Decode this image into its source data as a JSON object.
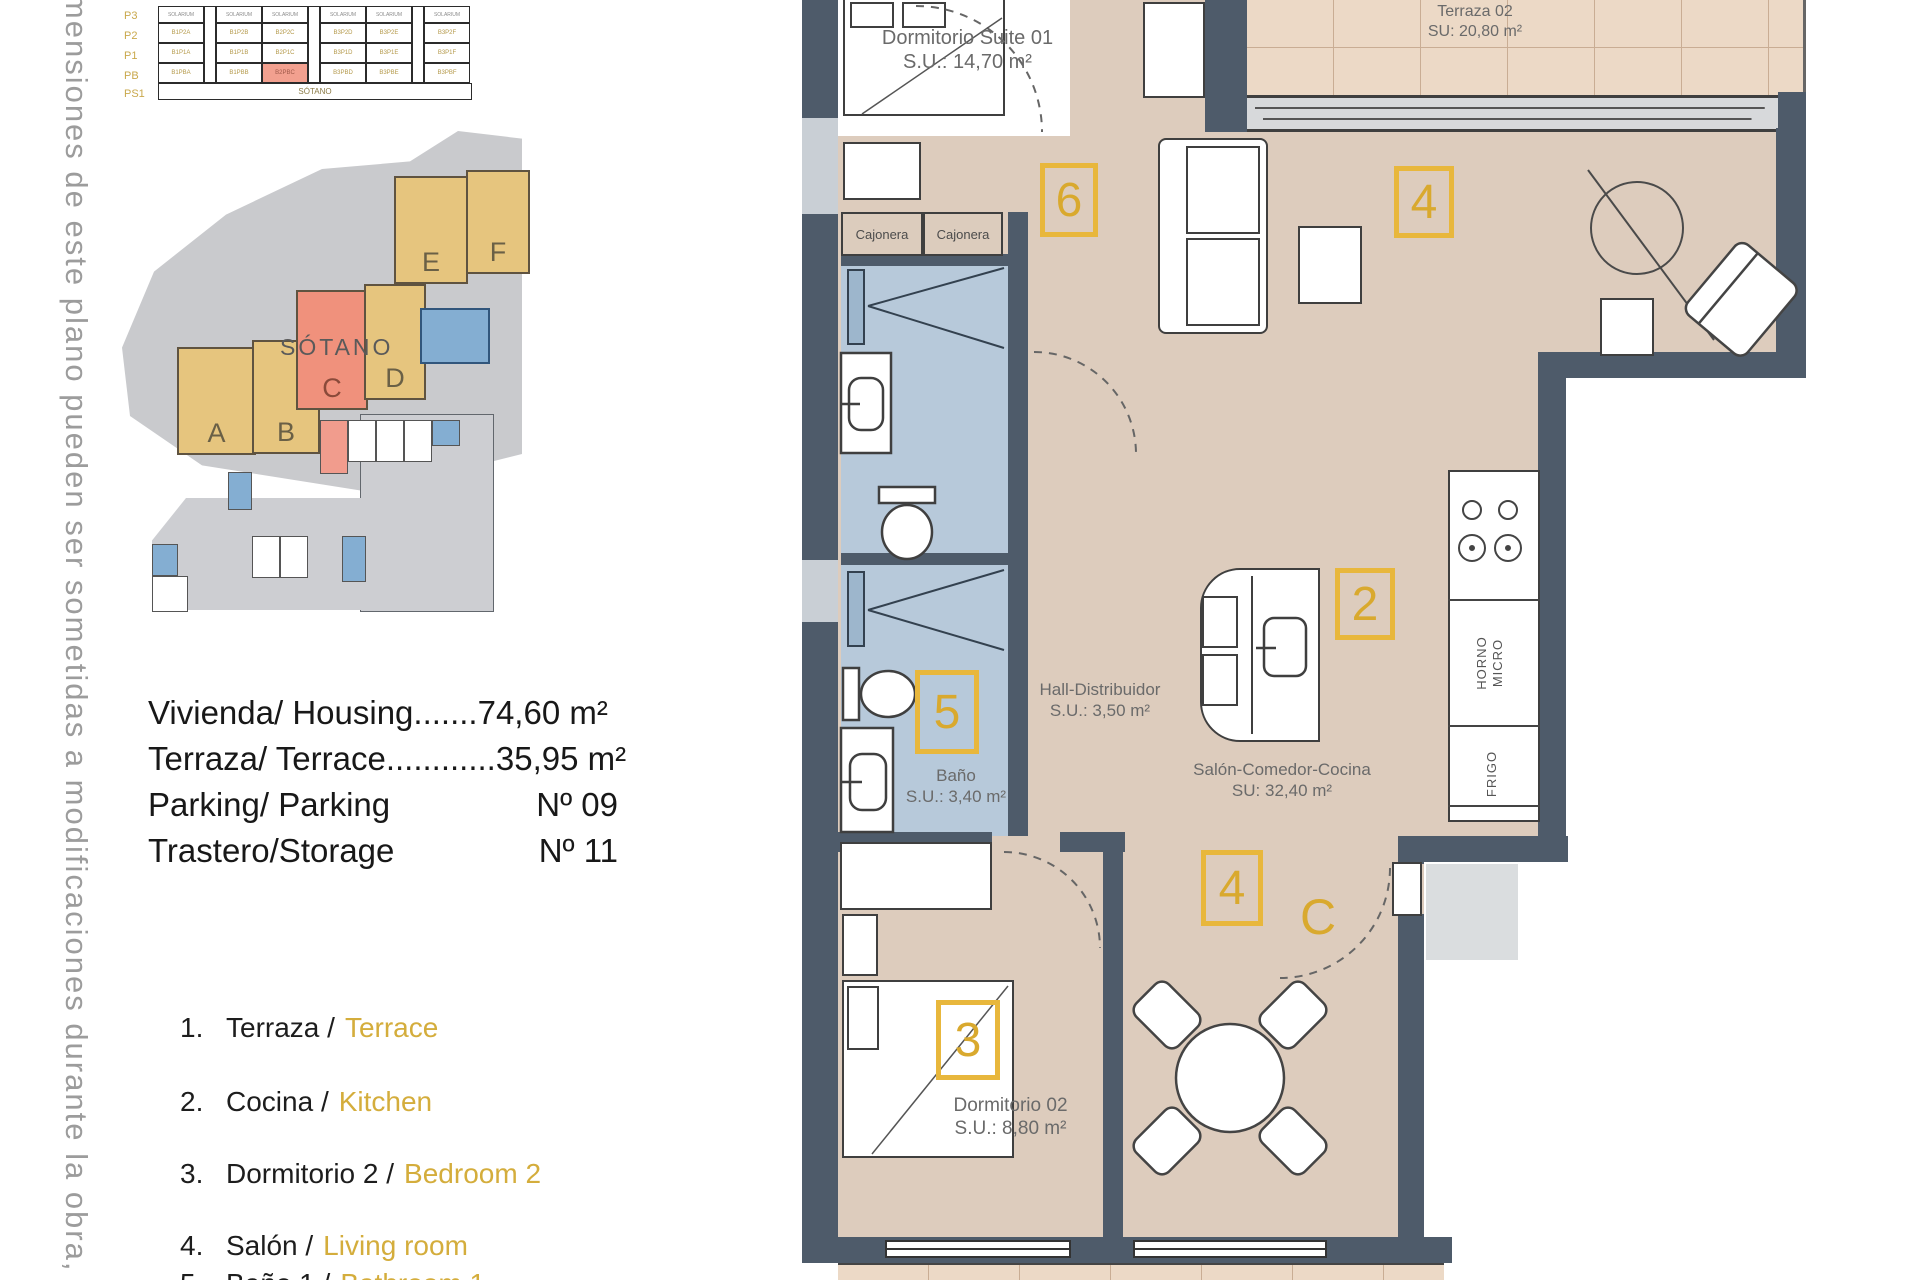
{
  "side_note": "imensiones de este plano pueden ser sometidas a modificaciones durante la obra, no teniendo v",
  "elevation": {
    "floors": [
      "P3",
      "P2",
      "P1",
      "PB"
    ],
    "basement_floor": "PS1",
    "solarium": "SOLARIUM",
    "sotano": "SÓTANO",
    "units": {
      "p2": [
        "B1P2A",
        "B1P2B",
        "B2P2C",
        "B3P2D",
        "B3P2E",
        "B3P2F"
      ],
      "p1": [
        "B1P1A",
        "B1P1B",
        "B2P1C",
        "B3P1D",
        "B3P1E",
        "B3P1F"
      ],
      "pb": [
        "B1PBA",
        "B1PBB",
        "B2PBC",
        "B3PBD",
        "B3PBE",
        "B3PBF"
      ]
    }
  },
  "site": {
    "blocks": [
      "A",
      "B",
      "C",
      "D",
      "E",
      "F"
    ]
  },
  "sotano_plan": {
    "title": "SÓTANO"
  },
  "summary": {
    "rows": [
      {
        "label": "Vivienda/ Housing",
        "dots": ".......",
        "value": "74,60 m²"
      },
      {
        "label": "Terraza/ Terrace",
        "dots": "............",
        "value": "35,95 m²"
      },
      {
        "label": "Parking/ Parking",
        "dots": "",
        "value": "Nº 09"
      },
      {
        "label": "Trastero/Storage",
        "dots": "",
        "value": "Nº 11"
      }
    ]
  },
  "legend": {
    "items": [
      {
        "num": "1.",
        "es": "Terraza /",
        "en": "Terrace"
      },
      {
        "num": "2.",
        "es": "Cocina /",
        "en": "Kitchen"
      },
      {
        "num": "3.",
        "es": "Dormitorio 2 /",
        "en": "Bedroom 2"
      },
      {
        "num": "4.",
        "es": "Salón /",
        "en": "Living room"
      },
      {
        "num": "5.",
        "es": "Baño 1 /",
        "en": "Bathroom 1"
      }
    ]
  },
  "plan": {
    "suite_name": "Dormitorio Suite 01",
    "suite_area": "S.U.: 14,70 m²",
    "terraza_name": "Terraza 02",
    "terraza_area": "SU: 20,80 m²",
    "hall_name": "Hall-Distribuidor",
    "hall_area": "S.U.: 3,50 m²",
    "bano_name": "Baño",
    "bano_area": "S.U.: 3,40 m²",
    "salon_name": "Salón-Comedor-Cocina",
    "salon_area": "SU: 32,40 m²",
    "dorm2_name": "Dormitorio 02",
    "dorm2_area": "S.U.: 8,80 m²",
    "cajonera": "Cajonera",
    "horno": "HORNO",
    "micro": "MICRO",
    "frigo": "FRIGO",
    "zone_suite": "6",
    "zone_living": "4",
    "zone_kitchen": "2",
    "zone_bath": "5",
    "zone_dining": "4",
    "zone_bedroom": "3",
    "entrance_letter": "C"
  },
  "colors": {
    "wall": "#4e5b6a",
    "floor": "#ddccbd",
    "tile": "#ecd9c6",
    "bath": "#b7c9da",
    "gold": "#e8b73c",
    "gold_text": "#d9a92e",
    "highlight": "#f0917c",
    "site_block": "#e6c57e"
  }
}
